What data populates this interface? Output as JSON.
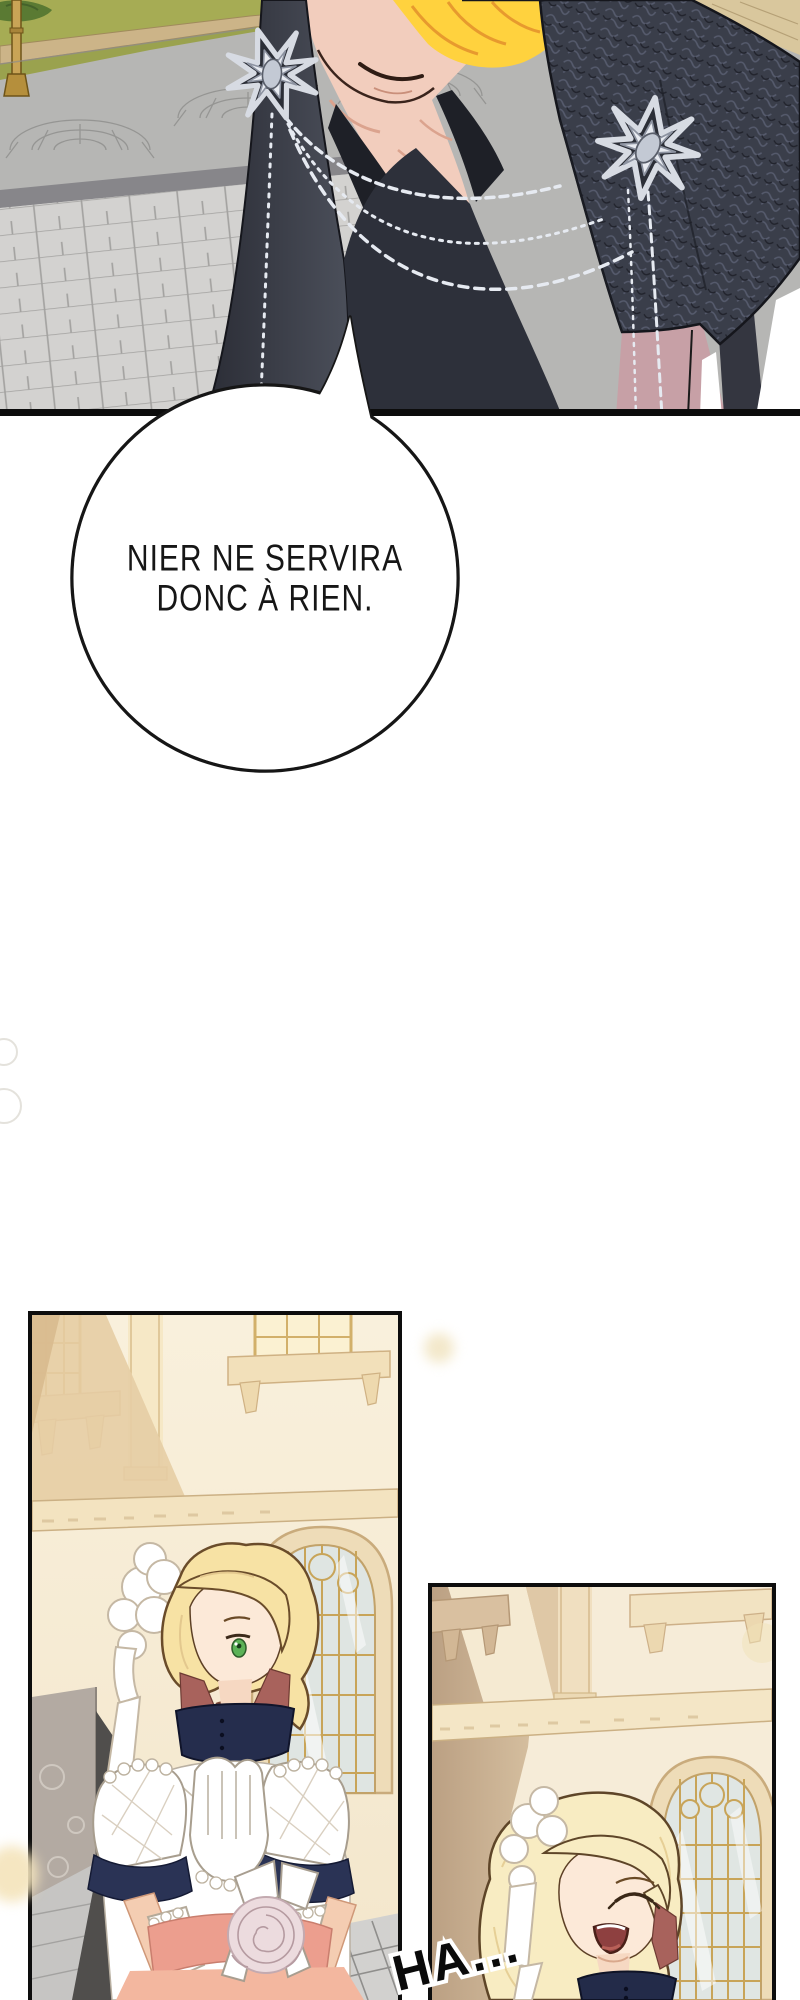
{
  "meta": {
    "kind": "webtoon comic page",
    "language": "French",
    "background": "#ffffff"
  },
  "speech_bubble": {
    "lines": [
      "NIER NE SERVIRA",
      "DONC À RIEN."
    ],
    "fill": "#ffffff",
    "outline": "#161616",
    "text_color": "#161616"
  },
  "sfx": {
    "label": "HA...",
    "color": "#0a0a0a",
    "outline_color": "#ffffff"
  },
  "panels": {
    "top": {
      "description": "Close-up of a smirking blond man in a dark navy brocade jacket with two silver star brooches joined by beaded chains; stone plaza, lawn strip and brass lamppost behind; dusty-pink backdrop at lower right"
    },
    "bottom_left": {
      "description": "Blonde bride with white lace headdress, one green eye visible, navy high collar, white puffed-sleeve gown, clasped gloved hands and pale rose bouquet, in front of a cream palace facade with arched window"
    },
    "bottom_right": {
      "description": "Same bride laughing nervously, eyes closed and mouth open, beside an arched window of the cream facade"
    }
  },
  "palette": {
    "panel_border": "#0d0d0d",
    "jacket_dark": "#2e3039",
    "jacket_texture": "#3a3e4a",
    "hair_blond": "#ffd23e",
    "skin": "#f2cdbd",
    "silver": "#d7dbe3",
    "dusty_pink": "#c7a0a6",
    "grass": "#9aa24e",
    "cobble_grey": "#b6b6b4",
    "paver_grey": "#d3d2d0",
    "cream_wall": "#f7eddb",
    "tan_shadow": "#e5cda4",
    "navy_dress": "#262e4e",
    "sash_pink": "#ec9e8e",
    "rust_shadow": "#a8625c",
    "eye_green": "#5cb257",
    "window_gold": "#c8a458"
  }
}
